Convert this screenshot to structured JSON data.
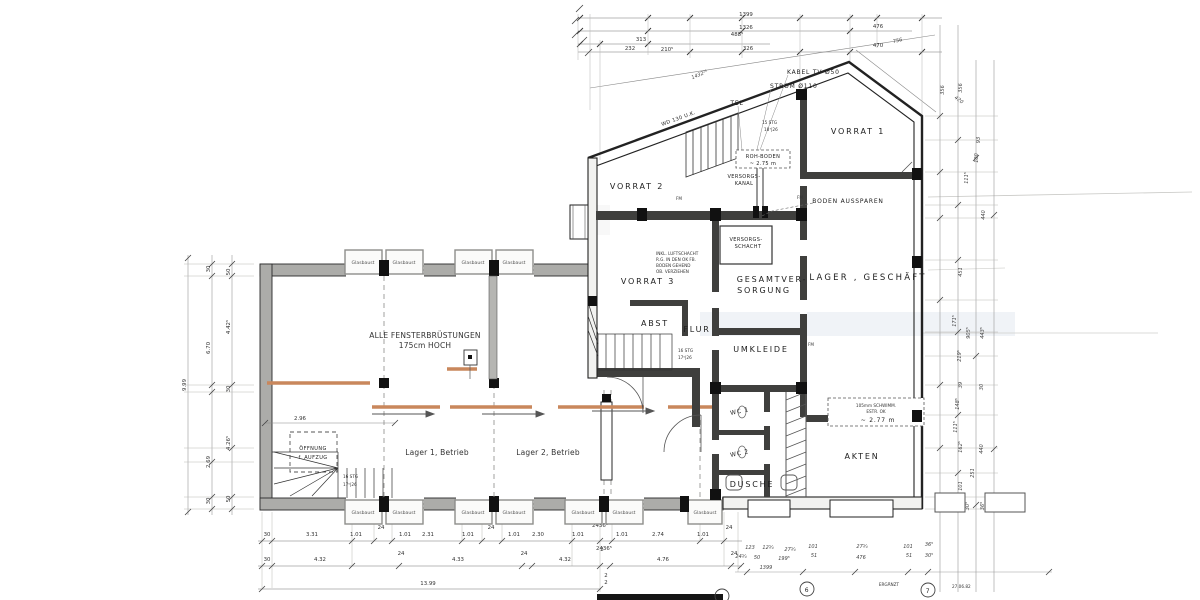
{
  "labels": {
    "glasbaust": "Glasbaust",
    "left": {
      "fenster1": "ALLE FENSTERBRÜSTUNGEN",
      "fenster2": "175cm HOCH",
      "lager1": "Lager 1, Betrieb",
      "lager2": "Lager 2, Betrieb",
      "oeffnung1": "ÖFFNUNG",
      "oeffnung2": "f. AUFZUG",
      "stg1": "16 STG",
      "stg2": "17⁵|26"
    },
    "right": {
      "vorrat1": "VORRAT 1",
      "vorrat2": "VORRAT 2",
      "vorrat3": "VORRAT 3",
      "lager_geschaeft": "LAGER , GESCHÄFT",
      "gesamt1": "GESAMTVER-",
      "gesamt2": "SORGUNG",
      "abst": "ABST",
      "flur": "FLUR",
      "umkleide": "UMKLEIDE",
      "wc1": "WC 1",
      "wc2": "WC 2",
      "dusche": "DUSCHE",
      "akten": "AKTEN",
      "versch1": "VERSORGS-",
      "versch2": "SCHACHT",
      "verkanal1": "VERSORGS-",
      "verkanal2": "KANAL",
      "rohboden1": "ROH-BODEN",
      "rohboden2": "~ 2.75 m",
      "boden_aussparen": "BODEN AUSSPAREN",
      "stg15a": "15 STG",
      "stg15b": "18⁷|26",
      "stg16a": "16 STG",
      "stg16b": "17⁵|26",
      "tel": "TEL",
      "wd130": "WD 130 U.K.",
      "kabel": "KABEL TV Ø50",
      "strom": "STROM Ø110",
      "estrich1": "105mm SCHWIMM.",
      "estrich2": "ESTR. OK",
      "estrich3": "~  2.77 m",
      "luft1": "INKL. LUFTSCHACHT",
      "luft2": "R.G. IN DEN OK FB.",
      "luft3": "BODEN GEHEND",
      "luft4": "OB. VERZIEHEN",
      "fm": "FM"
    }
  },
  "dims": {
    "top": [
      "1399",
      "1326",
      "488⁵",
      "313",
      "476",
      "756",
      "232",
      "210⁵",
      "326",
      "470",
      "1432²⁵",
      "420"
    ],
    "right": [
      "356",
      "356",
      "93",
      "180",
      "111⁵",
      "440",
      "451",
      "171⁵",
      "905⁵",
      "443⁵",
      "219⁵",
      "39",
      "30",
      "148⁵",
      "111⁵",
      "162⁵",
      "440",
      "251",
      "101",
      "30⁵",
      "36⁵"
    ],
    "left": [
      "9.99",
      "30",
      "6.70",
      "2.69",
      "30",
      "50",
      "4.42⁵",
      "30",
      "4.26⁵",
      "50"
    ],
    "b1": [
      "30",
      "3.31",
      "1.01",
      "24",
      "1.01",
      "2.31",
      "1.01",
      "24",
      "1.01",
      "2.30",
      "1.01",
      "2436⁵",
      "2",
      "1.01",
      "2.74",
      "1.01",
      "24"
    ],
    "b2": [
      "30",
      "4.32",
      "24",
      "4.33",
      "24",
      "4.32",
      "2436⁵",
      "2",
      "2",
      "4.76",
      "24"
    ],
    "b3": [
      "13.99"
    ],
    "hand": [
      "123",
      "12¾",
      "27¾",
      "101",
      "51",
      "27¾",
      "476",
      "101",
      "51",
      "24¾",
      "50",
      "199⁵",
      "36⁵",
      "30⁵",
      "1399"
    ],
    "inner": [
      "2.96"
    ]
  },
  "bubbles": [
    "6",
    "7"
  ],
  "notes": {
    "ergaenzt": "ERGÄNZT",
    "date": "27.06.82"
  }
}
